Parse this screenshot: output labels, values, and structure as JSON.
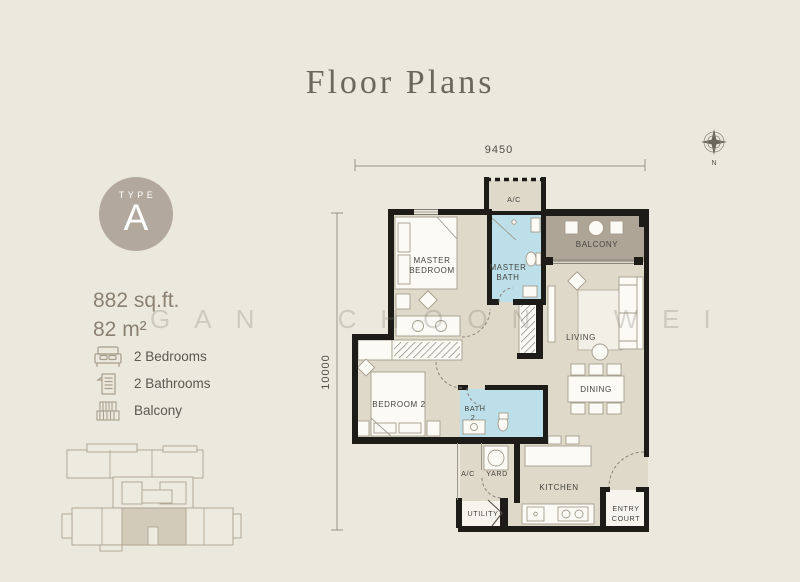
{
  "page": {
    "title": "Floor Plans"
  },
  "unit": {
    "type_label": "TYPE",
    "type_letter": "A",
    "area_sqft": "882 sq.ft.",
    "area_m2": "82 m²"
  },
  "features": {
    "bedrooms": "2 Bedrooms",
    "bathrooms": "2 Bathrooms",
    "balcony": "Balcony"
  },
  "dimensions": {
    "width": "9450",
    "height": "10000"
  },
  "compass": {
    "north": "N"
  },
  "watermark": "GAN CHOON WEI",
  "plan": {
    "labels": {
      "ac_top": "A/C",
      "master_bedroom_1": "MASTER",
      "master_bedroom_2": "BEDROOM",
      "master_bath_1": "MASTER",
      "master_bath_2": "BATH",
      "balcony": "BALCONY",
      "living": "LIVING",
      "dining": "DINING",
      "bedroom2": "BEDROOM 2",
      "bath2_1": "BATH",
      "bath2_2": "2",
      "ac_bottom": "A/C",
      "yard": "YARD",
      "kitchen": "KITCHEN",
      "utility": "UTILITY",
      "entry_1": "ENTRY",
      "entry_2": "COURT"
    }
  },
  "colors": {
    "background": "#EBE8DE",
    "badge": "#B2A89D",
    "floor": "#DFD9C9",
    "bathroom": "#BCDFE9",
    "balcony_floor": "#AFA597",
    "wall": "#1D1C19",
    "accent_text": "#8B8173",
    "keyplan_highlight": "#D2CBBA"
  }
}
